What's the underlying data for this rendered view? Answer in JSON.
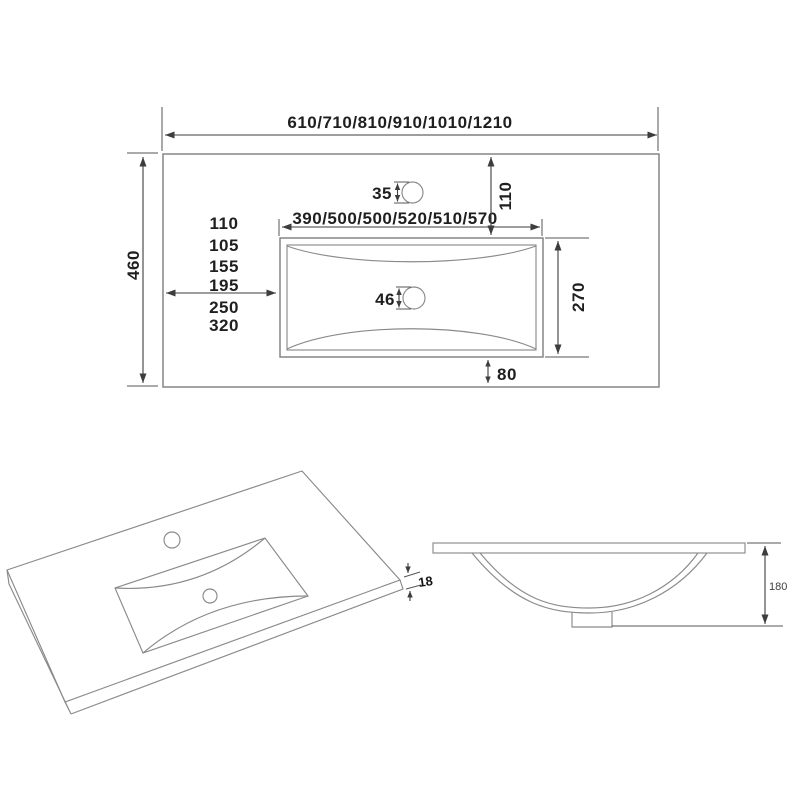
{
  "meta": {
    "background_color": "#ffffff",
    "ink_color": "#1f1f1f",
    "dimension_line_color": "#3d3d3d",
    "object_line_color": "#7d7d7d"
  },
  "plan_view": {
    "overall_width": "610/710/810/910/1010/1210",
    "overall_depth": "460",
    "basin_width": "390/500/500/520/510/570",
    "basin_depth": "270",
    "faucet_setback": "110",
    "faucet_hole_dia": "35",
    "drain_hole_dia": "46",
    "rear_gap": "80",
    "left_offsets": [
      "110",
      "105",
      "155",
      "195",
      "250",
      "320"
    ]
  },
  "perspective_view": {
    "thickness": "18"
  },
  "section_view": {
    "bowl_depth": "180"
  }
}
